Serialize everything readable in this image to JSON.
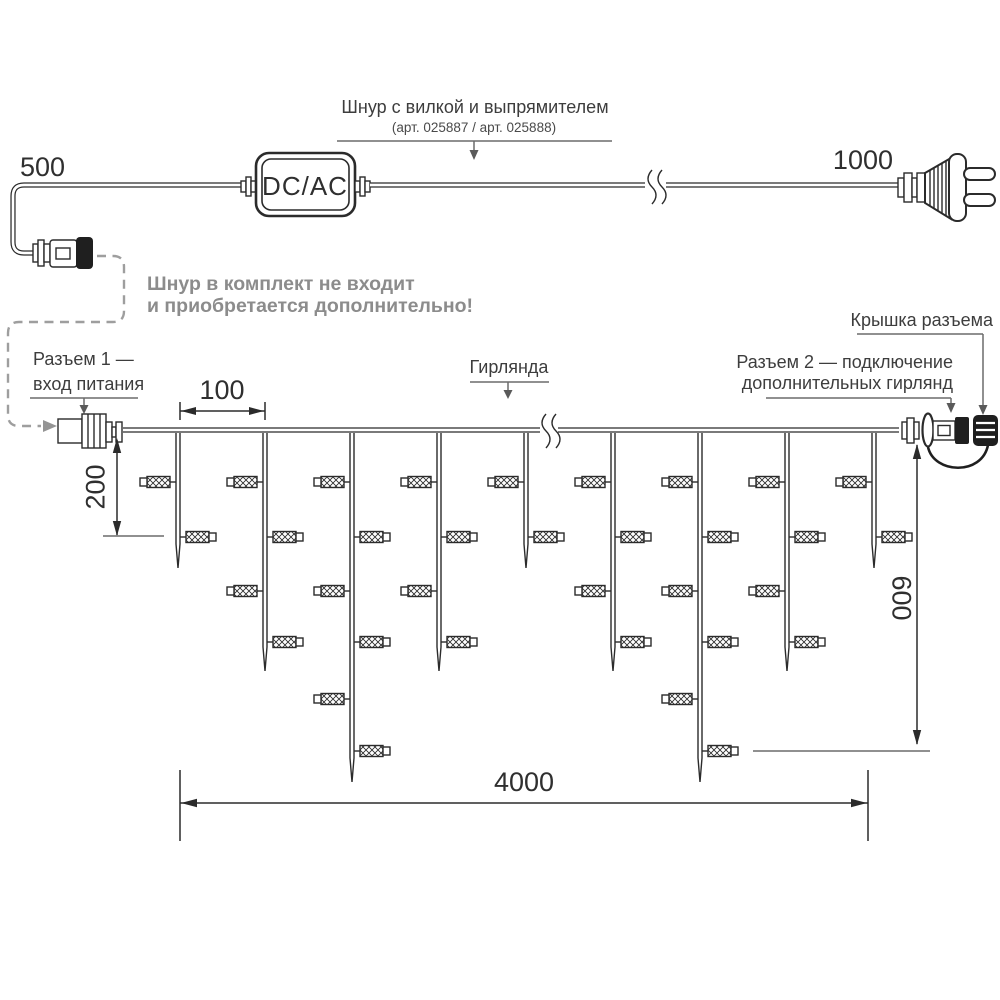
{
  "labels": {
    "title": "Шнур с вилкой и выпрямителем",
    "subtitle": "(арт. 025887 / арт. 025888)",
    "note_line1": "Шнур в комплект не входит",
    "note_line2": "и приобретается дополнительно!",
    "converter": "DC/AC",
    "connector1_line1": "Разъем 1 —",
    "connector1_line2": "вход питания",
    "garland": "Гирлянда",
    "connector2_line1": "Разъем 2 — подключение",
    "connector2_line2": "дополнительных гирлянд",
    "cap": "Крышка разъема"
  },
  "dimensions": {
    "cord_left_mm": "500",
    "cord_right_mm": "1000",
    "drop_spacing_mm": "100",
    "short_drop_mm": "200",
    "curtain_height_mm": "600",
    "garland_length_mm": "4000"
  },
  "colors": {
    "ink": "#2b2b2b",
    "label": "#3d3d3d",
    "muted_note": "#8c8c8c",
    "leader_gray": "#6b6b6b",
    "dashed_gray": "#9e9e9e",
    "background": "#ffffff"
  },
  "garland": {
    "wire_y": 430,
    "drop_xs": [
      178,
      265,
      352,
      439,
      526,
      613,
      700,
      787,
      874
    ],
    "drop_bulb_counts": [
      2,
      4,
      6,
      4,
      2,
      4,
      6,
      4,
      2
    ],
    "bulb_row_ys": [
      482,
      537,
      591,
      642,
      699,
      751
    ],
    "short_drop_bottom_y": 568,
    "medium_drop_bottom_y": 671,
    "long_drop_bottom_y": 782,
    "total_bulbs": 34
  }
}
